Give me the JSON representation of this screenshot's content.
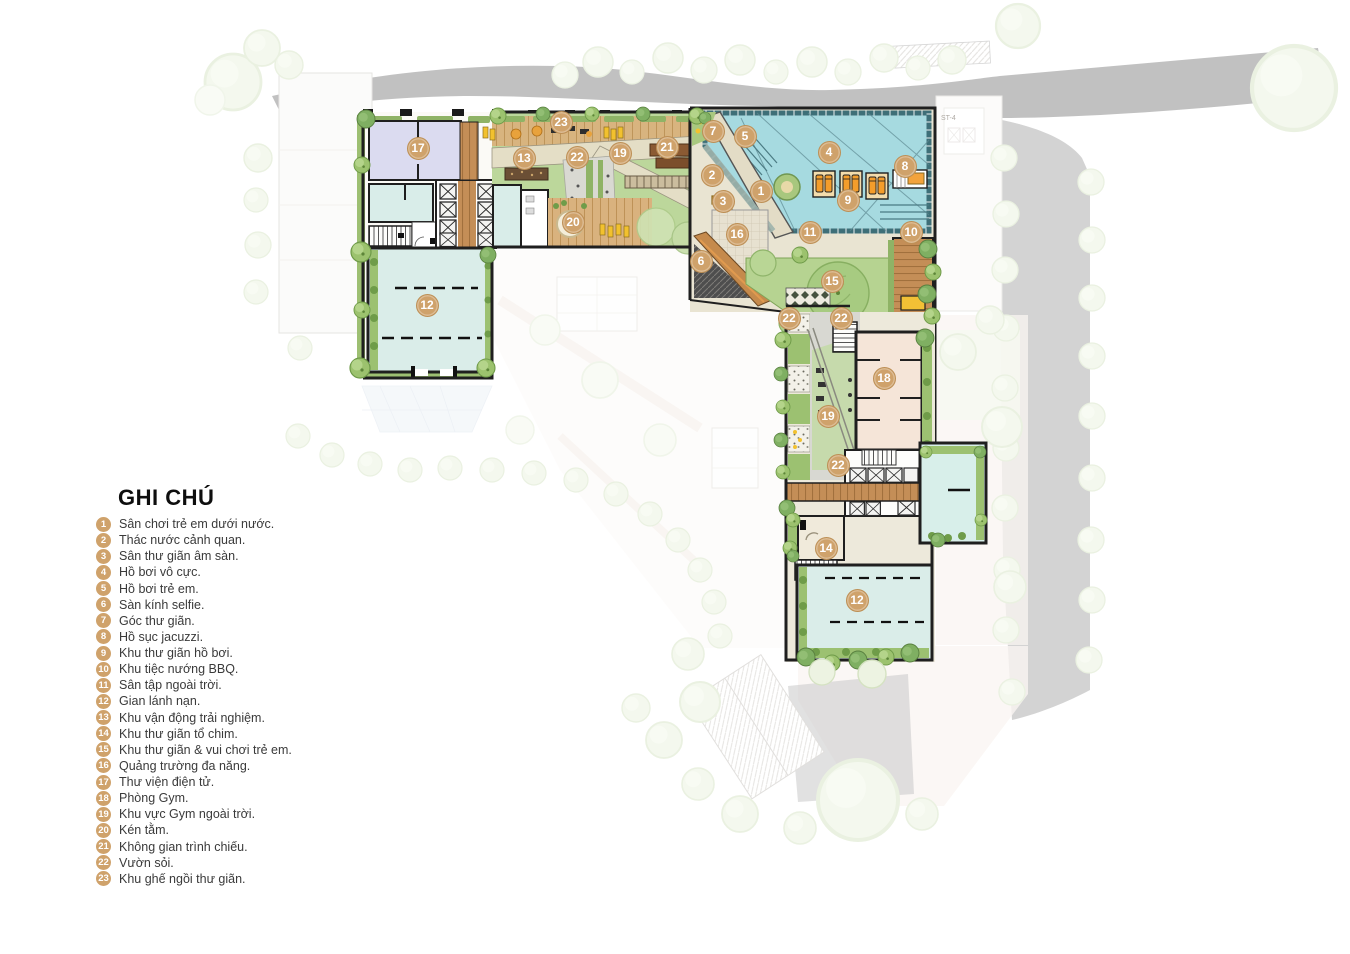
{
  "legend": {
    "title": "GHI CHÚ",
    "items": [
      {
        "num": "1",
        "label": "Sân chơi trẻ em dưới nước."
      },
      {
        "num": "2",
        "label": "Thác nước cảnh quan."
      },
      {
        "num": "3",
        "label": "Sân thư giãn âm sàn."
      },
      {
        "num": "4",
        "label": "Hồ bơi vô cực."
      },
      {
        "num": "5",
        "label": "Hồ bơi trẻ em."
      },
      {
        "num": "6",
        "label": "Sàn kính selfie."
      },
      {
        "num": "7",
        "label": "Góc thư giãn."
      },
      {
        "num": "8",
        "label": "Hồ sục jacuzzi."
      },
      {
        "num": "9",
        "label": "Khu thư giãn hồ bơi."
      },
      {
        "num": "10",
        "label": "Khu tiệc nướng BBQ."
      },
      {
        "num": "11",
        "label": "Sân tập ngoài trời."
      },
      {
        "num": "12",
        "label": "Gian lánh nạn."
      },
      {
        "num": "13",
        "label": "Khu vận động trải nghiệm."
      },
      {
        "num": "14",
        "label": "Khu thư giãn tổ chim."
      },
      {
        "num": "15",
        "label": "Khu thư giãn & vui chơi trẻ em."
      },
      {
        "num": "16",
        "label": "Quảng trường đa năng."
      },
      {
        "num": "17",
        "label": "Thư viện điện tử."
      },
      {
        "num": "18",
        "label": "Phòng Gym."
      },
      {
        "num": "19",
        "label": "Khu vực Gym ngoài trời."
      },
      {
        "num": "20",
        "label": "Kén tằm."
      },
      {
        "num": "21",
        "label": "Không gian trình chiếu."
      },
      {
        "num": "22",
        "label": "Vườn sỏi."
      },
      {
        "num": "23",
        "label": "Khu ghế ngồi thư giãn."
      }
    ]
  },
  "markers": [
    {
      "num": "7",
      "x": 713,
      "y": 131
    },
    {
      "num": "5",
      "x": 745,
      "y": 136
    },
    {
      "num": "4",
      "x": 829,
      "y": 152
    },
    {
      "num": "8",
      "x": 905,
      "y": 166
    },
    {
      "num": "2",
      "x": 712,
      "y": 175
    },
    {
      "num": "1",
      "x": 761,
      "y": 191
    },
    {
      "num": "3",
      "x": 723,
      "y": 201
    },
    {
      "num": "9",
      "x": 848,
      "y": 200
    },
    {
      "num": "23",
      "x": 561,
      "y": 122
    },
    {
      "num": "13",
      "x": 524,
      "y": 158
    },
    {
      "num": "22",
      "x": 577,
      "y": 157
    },
    {
      "num": "19",
      "x": 620,
      "y": 153
    },
    {
      "num": "21",
      "x": 667,
      "y": 147
    },
    {
      "num": "17",
      "x": 418,
      "y": 148
    },
    {
      "num": "20",
      "x": 573,
      "y": 222
    },
    {
      "num": "16",
      "x": 737,
      "y": 234
    },
    {
      "num": "11",
      "x": 810,
      "y": 232
    },
    {
      "num": "10",
      "x": 911,
      "y": 232
    },
    {
      "num": "6",
      "x": 701,
      "y": 261
    },
    {
      "num": "15",
      "x": 832,
      "y": 281
    },
    {
      "num": "12",
      "x": 427,
      "y": 305
    },
    {
      "num": "22",
      "x": 789,
      "y": 318
    },
    {
      "num": "22",
      "x": 841,
      "y": 318
    },
    {
      "num": "18",
      "x": 884,
      "y": 378
    },
    {
      "num": "19",
      "x": 828,
      "y": 416
    },
    {
      "num": "22",
      "x": 838,
      "y": 465
    },
    {
      "num": "14",
      "x": 826,
      "y": 548
    },
    {
      "num": "12",
      "x": 857,
      "y": 600
    }
  ],
  "background": {
    "stair_label": "ST-4"
  },
  "colors": {
    "marker": "#CFA26B",
    "pool_water": "#A6DAE0",
    "pool_edge": "#3E6F78",
    "lawn": "#B6D391",
    "wood_deck": "#C48E57",
    "refuge_room": "#DAEDE9",
    "library_room": "#DBDBF0",
    "gym_room": "#F5E5D8"
  }
}
